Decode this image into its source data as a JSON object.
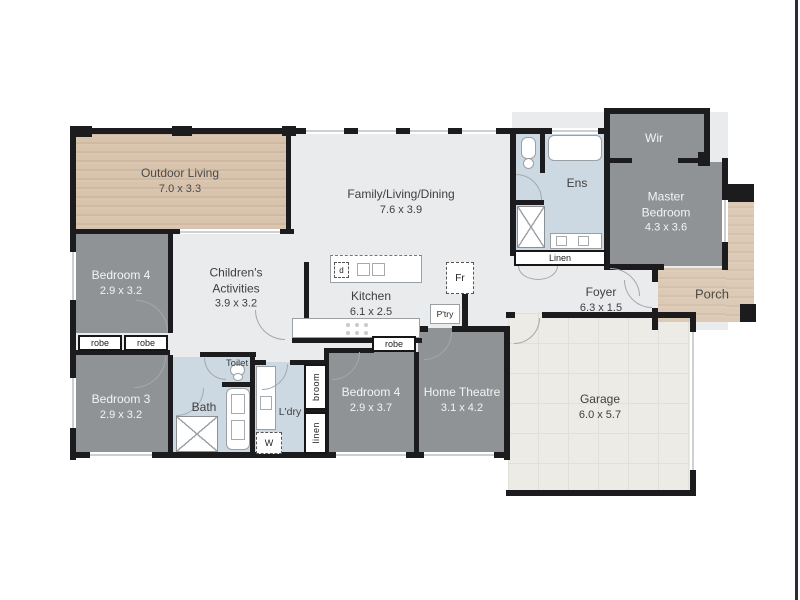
{
  "plan": {
    "rooms": {
      "outdoor_living": {
        "name": "Outdoor Living",
        "dims": "7.0 x 3.3"
      },
      "family": {
        "name": "Family/Living/Dining",
        "dims": "7.6 x 3.9"
      },
      "kitchen": {
        "name": "Kitchen",
        "dims": "6.1 x 2.5"
      },
      "childrens_activities": {
        "name_line1": "Children's",
        "name_line2": "Activities",
        "dims": "3.9 x 3.2"
      },
      "bedroom4_left": {
        "name": "Bedroom 4",
        "dims": "2.9 x 3.2"
      },
      "bedroom3": {
        "name": "Bedroom 3",
        "dims": "2.9 x 3.2"
      },
      "toilet": {
        "name": "Toilet"
      },
      "bath": {
        "name": "Bath"
      },
      "laundry": {
        "name": "L'dry"
      },
      "bedroom4_mid": {
        "name": "Bedroom 4",
        "dims": "2.9 x 3.7"
      },
      "home_theatre": {
        "name": "Home Theatre",
        "dims": "3.1 x 4.2"
      },
      "garage": {
        "name": "Garage",
        "dims": "6.0 x 5.7"
      },
      "foyer": {
        "name": "Foyer",
        "dims": "6.3 x 1.5"
      },
      "ensuite": {
        "name": "Ens"
      },
      "wir": {
        "name": "Wir"
      },
      "master_bedroom": {
        "name_line1": "Master",
        "name_line2": "Bedroom",
        "dims": "4.3 x 3.6"
      },
      "porch": {
        "name": "Porch"
      }
    },
    "storage": {
      "robe_left_1": "robe",
      "robe_left_2": "robe",
      "robe_mid": "robe",
      "broom": "broom",
      "linen_cupboard": "linen",
      "linen_hall": "Linen"
    },
    "appliances": {
      "dishwasher": "d",
      "fridge": "Fr",
      "pantry": "P'try",
      "washer": "W"
    },
    "colors": {
      "wall": "#1c1c1e",
      "bedroom_fill": "#8f9396",
      "wet_area_fill": "#cdd9e2",
      "living_fill": "#e9ebec",
      "deck_fill": "#d8c3ad",
      "porch_fill": "#dccab6",
      "garage_fill": "#edebe6",
      "label_dark": "#3e3f40",
      "label_light": "#f3f4f4"
    }
  }
}
